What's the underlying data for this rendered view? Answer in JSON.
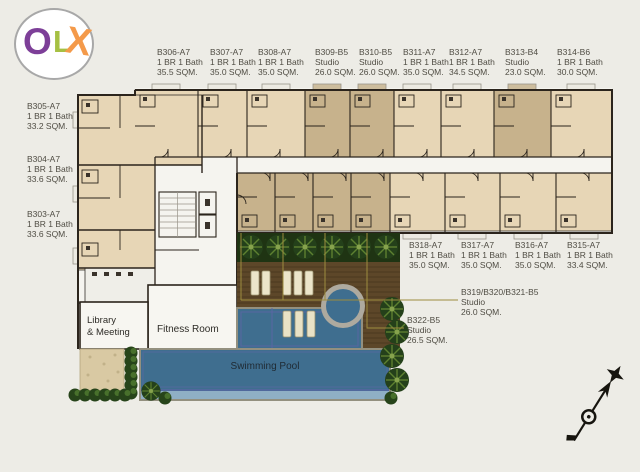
{
  "logo": {
    "letters": [
      "O",
      "L",
      "X"
    ],
    "colors": {
      "o": "#7d3f98",
      "l": "#a6c043",
      "x": "#f49a4a"
    }
  },
  "units": {
    "top": [
      {
        "id": "B306-A7",
        "type": "1 BR 1 Bath",
        "area": "35.5 SQM."
      },
      {
        "id": "B307-A7",
        "type": "1 BR 1 Bath",
        "area": "35.0 SQM."
      },
      {
        "id": "B308-A7",
        "type": "1 BR 1 Bath",
        "area": "35.0 SQM."
      },
      {
        "id": "B309-B5",
        "type": "Studio",
        "area": "26.0 SQM."
      },
      {
        "id": "B310-B5",
        "type": "Studio",
        "area": "26.0 SQM."
      },
      {
        "id": "B311-A7",
        "type": "1 BR 1 Bath",
        "area": "35.0 SQM."
      },
      {
        "id": "B312-A7",
        "type": "1 BR 1 Bath",
        "area": "34.5 SQM."
      },
      {
        "id": "B313-B4",
        "type": "Studio",
        "area": "23.0 SQM."
      },
      {
        "id": "B314-B6",
        "type": "1 BR 1 Bath",
        "area": "30.0 SQM."
      }
    ],
    "left": [
      {
        "id": "B305-A7",
        "type": "1 BR 1 Bath",
        "area": "33.2 SQM."
      },
      {
        "id": "B304-A7",
        "type": "1 BR 1 Bath",
        "area": "33.6 SQM."
      },
      {
        "id": "B303-A7",
        "type": "1 BR 1 Bath",
        "area": "33.6 SQM."
      }
    ],
    "bottom": [
      {
        "id": "B318-A7",
        "type": "1 BR 1 Bath",
        "area": "35.0 SQM."
      },
      {
        "id": "B317-A7",
        "type": "1 BR 1 Bath",
        "area": "35.0 SQM."
      },
      {
        "id": "B316-A7",
        "type": "1 BR 1 Bath",
        "area": "35.0 SQM."
      },
      {
        "id": "B315-A7",
        "type": "1 BR 1 Bath",
        "area": "33.4 SQM."
      }
    ],
    "callouts": [
      {
        "id": "B319/B320/B321-B5",
        "type": "Studio",
        "area": "26.0 SQM."
      },
      {
        "id": "B322-B5",
        "type": "Studio",
        "area": "26.5 SQM."
      }
    ]
  },
  "amenities": {
    "library_line1": "Library",
    "library_line2": "& Meeting",
    "fitness": "Fitness Room",
    "pool": "Swimming Pool"
  },
  "palette": {
    "background": "#edece6",
    "unit_fill": "#e7d6b6",
    "studio_highlight": "#c7b28c",
    "wall": "#2b241c",
    "corridor": "#f5f4ef",
    "pool_water": "#3f6e8f",
    "pool_overflow": "#8fafc5",
    "pool_line": "#5a66a3",
    "deck_wood": "#5d4729",
    "plants_green": "#27441a",
    "leader_line": "#9d8c3e",
    "sand": "#d9c9a3"
  }
}
